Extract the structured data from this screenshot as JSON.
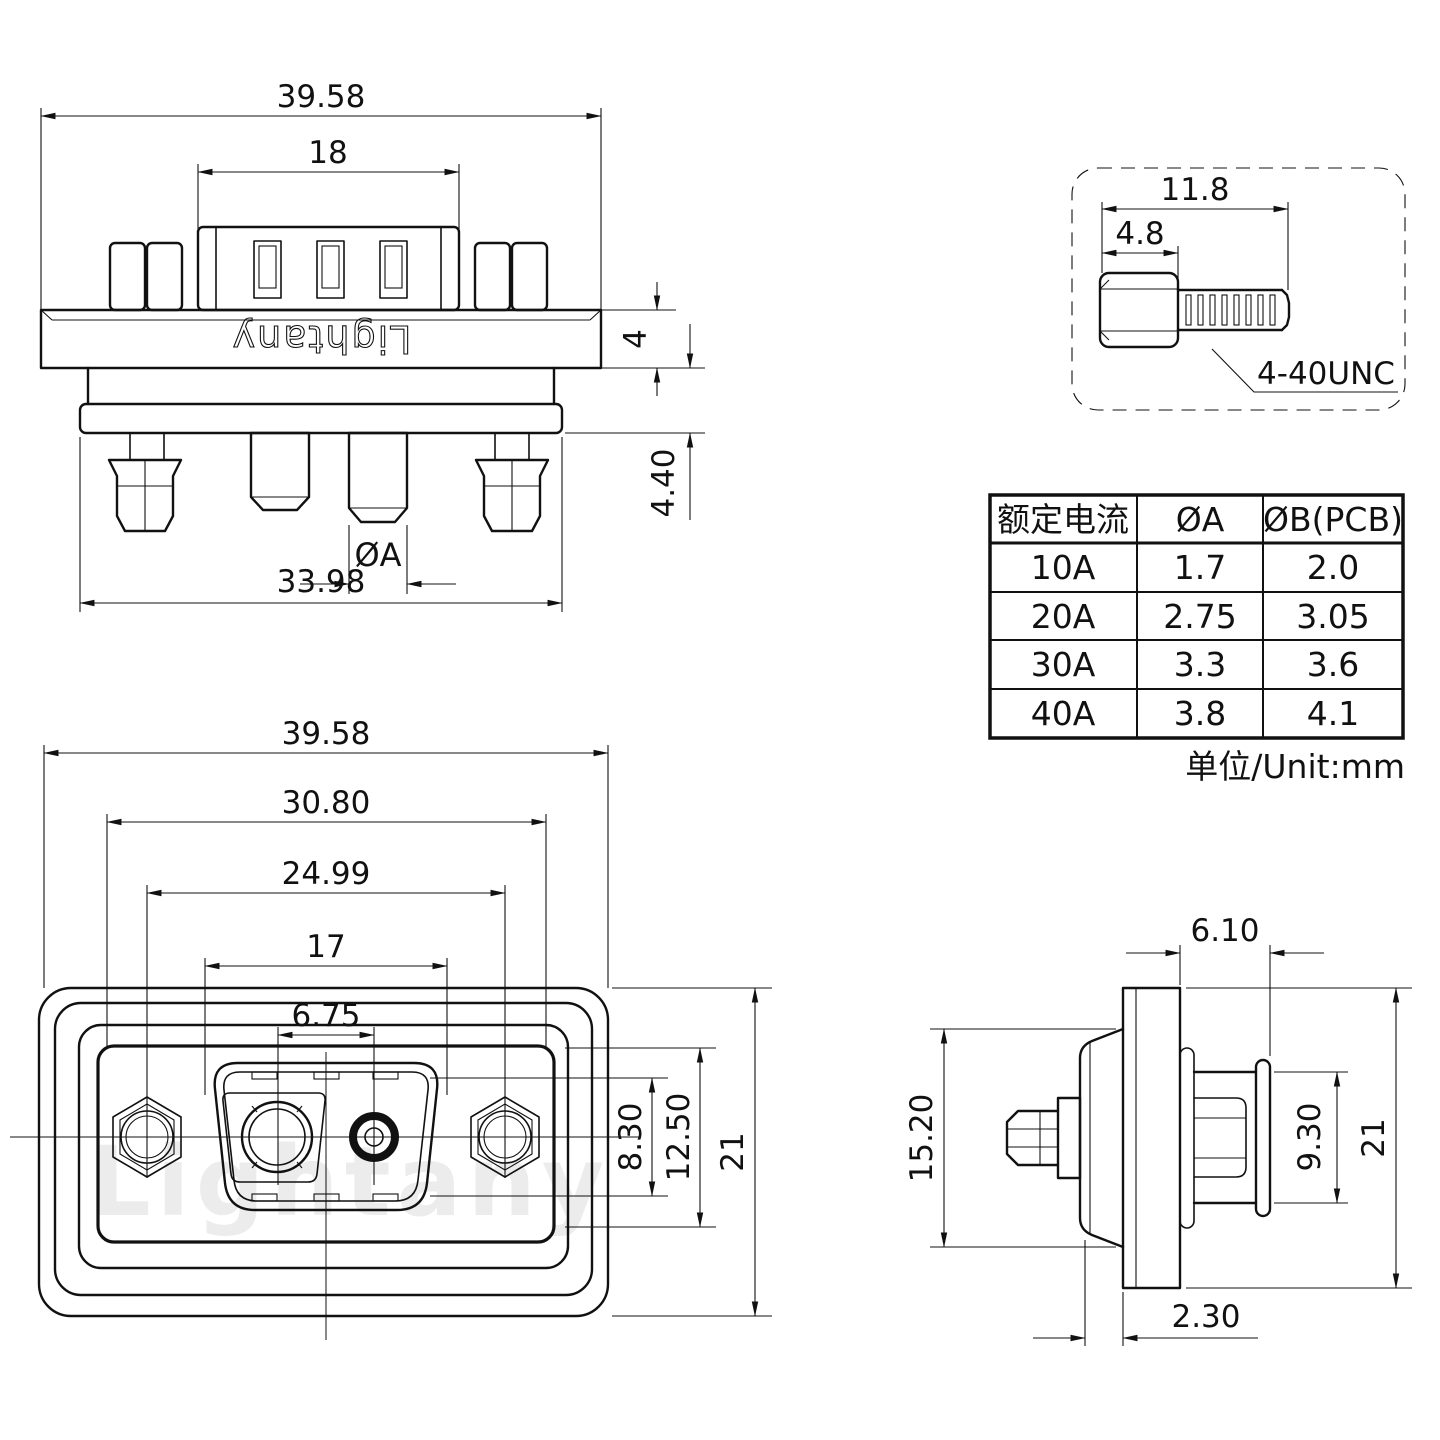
{
  "page": {
    "background": "#ffffff",
    "line_color": "#111111"
  },
  "views": {
    "top_view": {
      "brand_engraving": "Lightany",
      "dims": {
        "overall_width": "39.58",
        "shroud_width": "18",
        "flange_thickness": "4",
        "pin_protrusion": "4.40",
        "pin_row_width": "33.98",
        "pin_diameter_label": "ØA"
      }
    },
    "screw_detail": {
      "dims": {
        "overall_length": "11.8",
        "head_length": "4.8"
      },
      "thread_label": "4-40UNC"
    },
    "front_view": {
      "watermark": "Lightany",
      "dims": {
        "overall_width": "39.58",
        "cutout_width": "30.80",
        "mounting_pitch": "24.99",
        "opening_width": "17",
        "contact_pitch": "6.75",
        "opening_height": "8.30",
        "insert_height": "12.50",
        "overall_height": "21"
      }
    },
    "side_view": {
      "dims": {
        "front_depth": "6.10",
        "body_height": "15.20",
        "insert_height": "9.30",
        "overall_height": "21",
        "panel_offset": "2.30"
      }
    },
    "spec_table": {
      "headers": [
        "额定电流",
        "ØA",
        "ØB(PCB)"
      ],
      "rows": [
        {
          "current": "10A",
          "dia_a": "1.7",
          "dia_b": "2.0"
        },
        {
          "current": "20A",
          "dia_a": "2.75",
          "dia_b": "3.05"
        },
        {
          "current": "30A",
          "dia_a": "3.3",
          "dia_b": "3.6"
        },
        {
          "current": "40A",
          "dia_a": "3.8",
          "dia_b": "4.1"
        }
      ],
      "unit_note": "单位/Unit:mm"
    }
  }
}
